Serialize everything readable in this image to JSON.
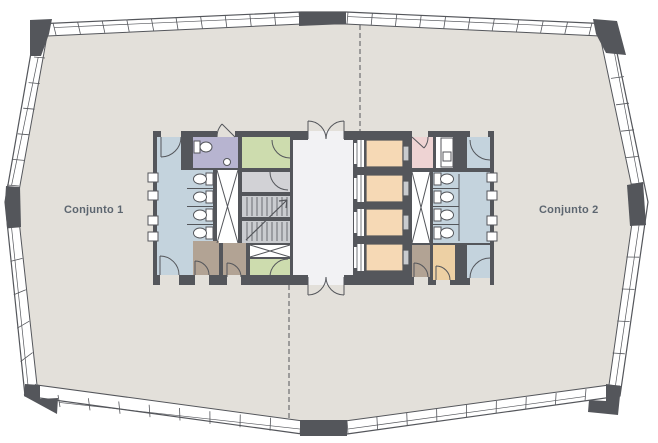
{
  "plan": {
    "title_hidden": "",
    "unit_left": "Conjunto 1",
    "unit_right": "Conjunto 2"
  },
  "colors": {
    "floor": "#e3e0da",
    "wall": "#54565b",
    "wet": "#c4d3dd",
    "accessible": "#b7b4d0",
    "green": "#cddcae",
    "pink": "#eed3d3",
    "elevator": "#f6d9b5",
    "taupe": "#b2a394",
    "tan": "#edd0a4",
    "vestibule": "#d2d2d6",
    "lobby": "#f2f2f4",
    "stair": "#caccd0",
    "label": "#5d6670"
  },
  "rooms": [
    {
      "name": "restroom-left",
      "color_key": "wet"
    },
    {
      "name": "accessible-wc",
      "color_key": "accessible"
    },
    {
      "name": "green-room-top-left",
      "color_key": "green"
    },
    {
      "name": "stair-vestibule",
      "color_key": "vestibule"
    },
    {
      "name": "stairs",
      "color_key": "stair"
    },
    {
      "name": "green-room-bottom-left",
      "color_key": "green"
    },
    {
      "name": "closet-a",
      "color_key": "taupe"
    },
    {
      "name": "closet-b",
      "color_key": "taupe"
    },
    {
      "name": "elevator-lobby",
      "color_key": "lobby"
    },
    {
      "name": "elevator-1",
      "color_key": "elevator"
    },
    {
      "name": "elevator-2",
      "color_key": "elevator"
    },
    {
      "name": "elevator-3",
      "color_key": "elevator"
    },
    {
      "name": "elevator-4",
      "color_key": "elevator"
    },
    {
      "name": "pink-room",
      "color_key": "pink"
    },
    {
      "name": "service-room",
      "color_key": "lobby"
    },
    {
      "name": "restroom-right",
      "color_key": "wet"
    },
    {
      "name": "closet-c",
      "color_key": "taupe"
    },
    {
      "name": "closet-d",
      "color_key": "tan"
    }
  ]
}
